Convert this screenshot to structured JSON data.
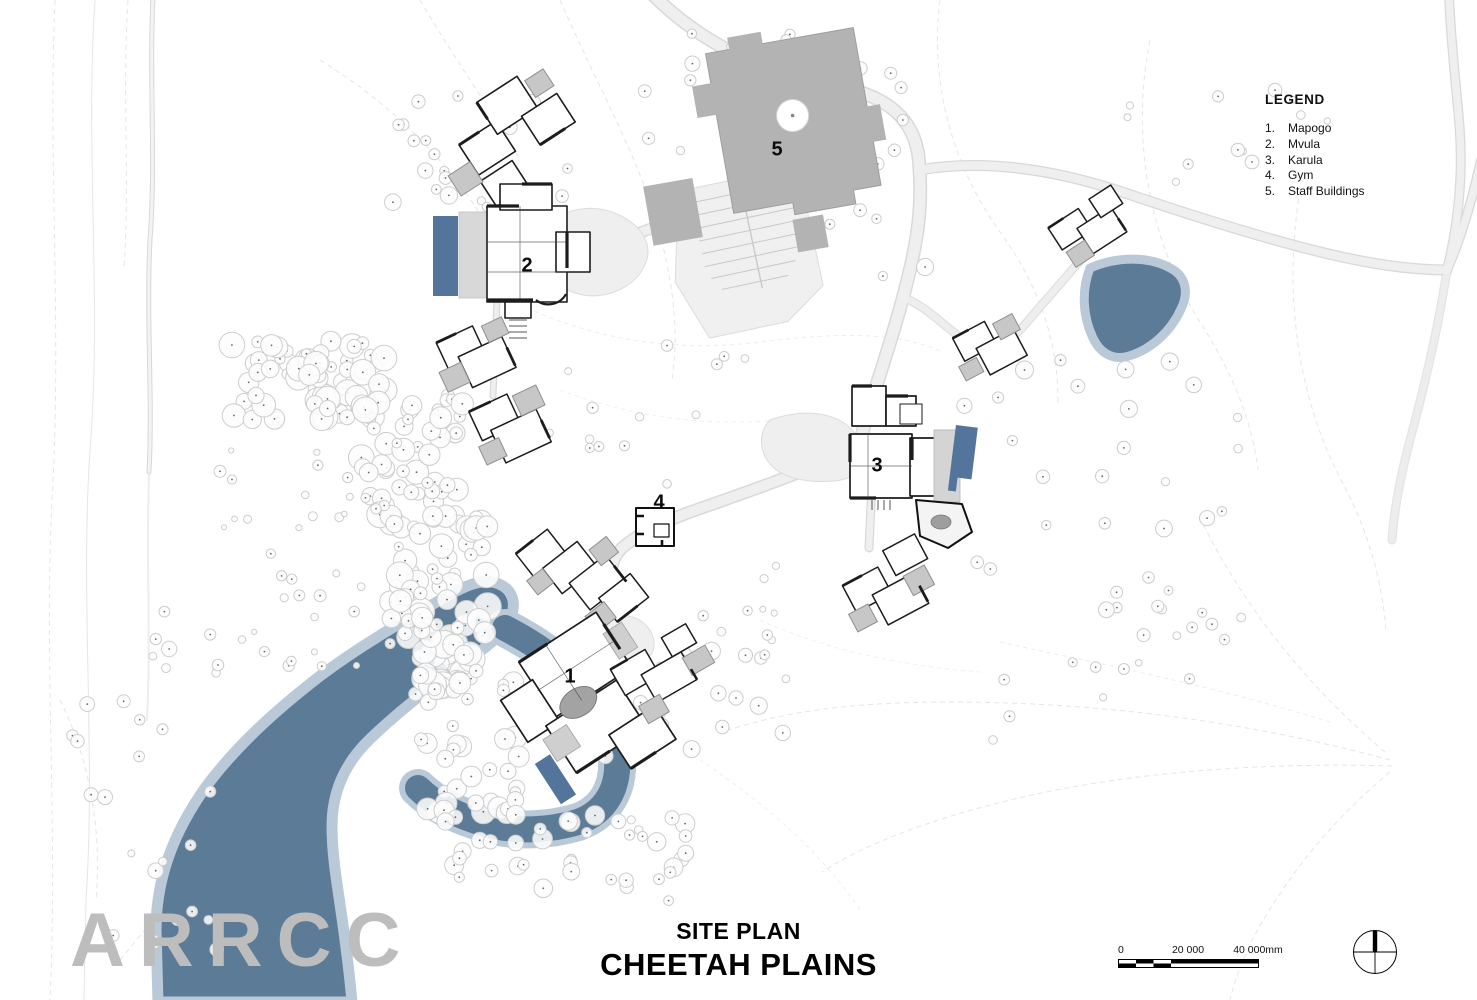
{
  "legend": {
    "title": "LEGEND",
    "items": [
      {
        "num": "1.",
        "label": "Mapogo"
      },
      {
        "num": "2.",
        "label": "Mvula"
      },
      {
        "num": "3.",
        "label": "Karula"
      },
      {
        "num": "4.",
        "label": "Gym"
      },
      {
        "num": "5.",
        "label": "Staff Buildings"
      }
    ]
  },
  "markers": [
    {
      "label": "1"
    },
    {
      "label": "2"
    },
    {
      "label": "3"
    },
    {
      "label": "4"
    },
    {
      "label": "5"
    }
  ],
  "title_block": {
    "subtitle": "SITE PLAN",
    "title": "CHEETAH PLAINS"
  },
  "logo": {
    "text": "ARRCC"
  },
  "scale_bar": {
    "zero": "0",
    "mid": "20 000",
    "end": "40 000mm"
  },
  "colors": {
    "water": "#5b7b97",
    "water_edge": "#b9c9d7",
    "pool": "#54759b",
    "building_gray": "#b3b3b3",
    "logo_gray": "#bdbdbd",
    "ink": "#1c1c1c"
  }
}
